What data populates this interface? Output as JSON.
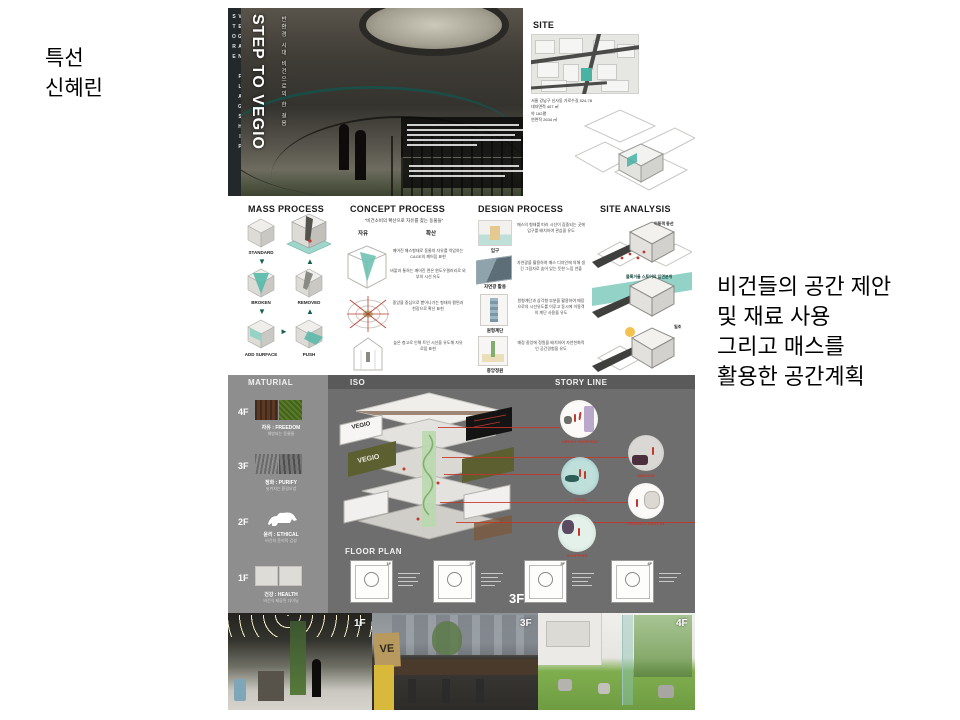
{
  "slide": {
    "award_line1": "특선",
    "award_line2": "신혜린",
    "annotation_lines": [
      "비건들의 공간 제안",
      "및 재료 사용",
      "그리고 매스를",
      "활용한 공간계획"
    ]
  },
  "poster": {
    "spine_text": "VEGAN FLAGSHIP STORE",
    "hero": {
      "title": "STEP TO VEGIO",
      "subtitle_vertical": "반환경 시대 비건으로의 한 걸음"
    },
    "site": {
      "header": "SITE",
      "address": "서울 강남구 신사동 가로수길 524-78",
      "area1": "대지면적 407 ㎡",
      "area2": "약 162평",
      "area3": "연면적 2634 ㎡"
    },
    "mass": {
      "header": "MASS PROCESS",
      "s1": "STANDARD",
      "s2": "BROKEN",
      "s3": "ADD SURFACE",
      "s4": "PUSH",
      "s5": "REMOVED"
    },
    "concept": {
      "header": "CONCEPT PROCESS",
      "quote": "\"비건소비의 확산으로 자유를 찾는 동물들\"",
      "kw1": "자유",
      "kw2": "확산",
      "t1": "깨어진 매스형태로 동물의 자유를 억압하는 CAGE의 깨어짐 표현",
      "t1b": "바깥과 통하는 깨어진 면은 윈도우갤러리로 외부의 시선 유도",
      "t2": "중앙을 중심으로 뻗어나가는 형태의 평면과 천장으로 확산 표현",
      "t3": "높은 층고로 인해 트인 시선을 유도해 자유로움 표현"
    },
    "design": {
      "header": "DESIGN PROCESS",
      "items": [
        {
          "label": "입구",
          "text": "매스의 형태를 따라 시선이 집중되는 곳에 입구를 배치하여 관심을 유도"
        },
        {
          "label": "자연광 활용",
          "text": "자연광을 활용하여 매스 디자인에 의해 생긴 그림자로 숨어 있는 듯한 느낌 연출"
        },
        {
          "label": "원형계단",
          "text": "원형계단과 삼각형 부분을 활용하여 매장으로의 시선유도를 이루고 동시에 이용객의 계단 사용을 유도"
        },
        {
          "label": "중앙정원",
          "text": "매장 중앙에 정원을 배치하여 자연친화적인 공간경험을 유도"
        }
      ]
    },
    "analysis": {
      "header": "SITE ANALYSIS",
      "l1": "이동객 동선",
      "l2": "블록거울 스토어의 입면분위",
      "l3": "일조"
    },
    "material": {
      "header": "MATURIAL",
      "floors": [
        {
          "level": "4F",
          "label": "자유 : FREEDOM",
          "sub": "해방되는 동물들"
        },
        {
          "level": "3F",
          "label": "정화 : PURIFY",
          "sub": "씻겨지는 환경오염"
        },
        {
          "level": "2F",
          "label": "윤리 : ETHICAL",
          "sub": "비건의 윤리적 감성"
        },
        {
          "level": "1F",
          "label": "건강 : HEALTH",
          "sub": "비건식 제공된 다이닝"
        }
      ]
    },
    "iso": {
      "header": "ISO",
      "panel_label": "VEGIO"
    },
    "story": {
      "header": "STORY LINE",
      "captions": [
        "GREEN SHOPPING",
        "WINDOW",
        "FOOD",
        "PRODUCT DISPLAY",
        "SHOPPING"
      ]
    },
    "floorplan": {
      "header": "FLOOR PLAN",
      "sups": [
        "1F",
        "2F",
        "3F",
        "4F"
      ],
      "big_label": "3F"
    },
    "photos": {
      "labels": [
        "1F",
        "3F",
        "4F"
      ],
      "sign": "VE"
    }
  },
  "colors": {
    "teal": "#49b2a3",
    "arrow_green": "#145f52",
    "red": "#c0392b",
    "gray_dark": "#6e6e6e",
    "gray_mid": "#8e8e8e",
    "olive": "#5c6030"
  }
}
